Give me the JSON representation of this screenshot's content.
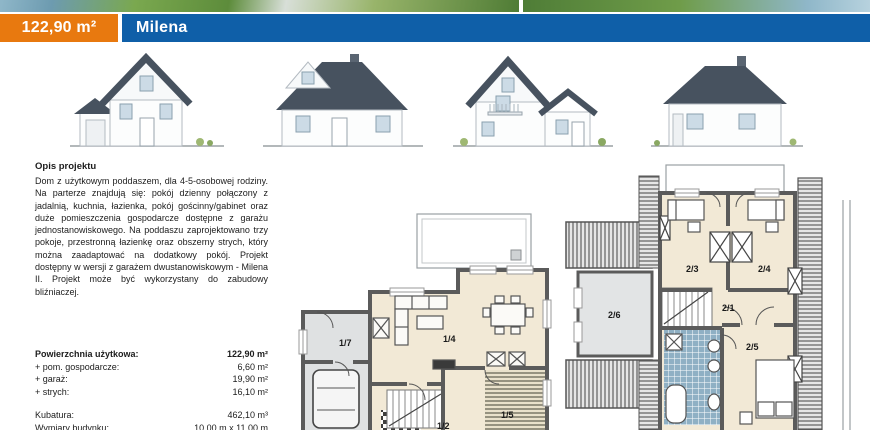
{
  "header": {
    "area_label": "122,90 m²",
    "project_name": "Milena",
    "accent_orange": "#e8790f",
    "accent_blue": "#0f5fa8"
  },
  "description": {
    "heading": "Opis projektu",
    "body": "Dom z użytkowym poddaszem, dla 4-5-osobowej rodziny. Na parterze znajdują się: pokój dzienny połączony z jadalnią, kuchnia, łazienka, pokój gościnny/gabinet oraz duże pomieszczenia gospodarcze dostępne z garażu jednostanowiskowego. Na poddaszu zaprojektowano trzy pokoje, przestronną łazienkę oraz obszerny strych, który można zaadaptować na dodatkowy pokój. Projekt dostępny w wersji z garażem dwustanowiskowym - Milena II. Projekt może być wykorzystany do zabudowy bliźniaczej."
  },
  "specs": {
    "rows": [
      {
        "label": "Powierzchnia użytkowa:",
        "value": "122,90 m²"
      },
      {
        "label": "+ pom. gospodarcze:",
        "value": "6,60 m²"
      },
      {
        "label": "+ garaż:",
        "value": "19,90 m²"
      },
      {
        "label": "+ strych:",
        "value": "16,10 m²"
      }
    ],
    "kubatura_label": "Kubatura:",
    "kubatura_value": "462,10 m³",
    "wymiary_label": "Wymiary budynku:",
    "wymiary_value": "10,00 m x 11,00 m"
  },
  "floor_plans": {
    "ground": {
      "room_17": "1/7",
      "room_14": "1/4",
      "room_12": "1/2",
      "room_15": "1/5"
    },
    "upper": {
      "room_26": "2/6",
      "room_23": "2/3",
      "room_24": "2/4",
      "room_21": "2/1",
      "room_25": "2/5"
    }
  }
}
